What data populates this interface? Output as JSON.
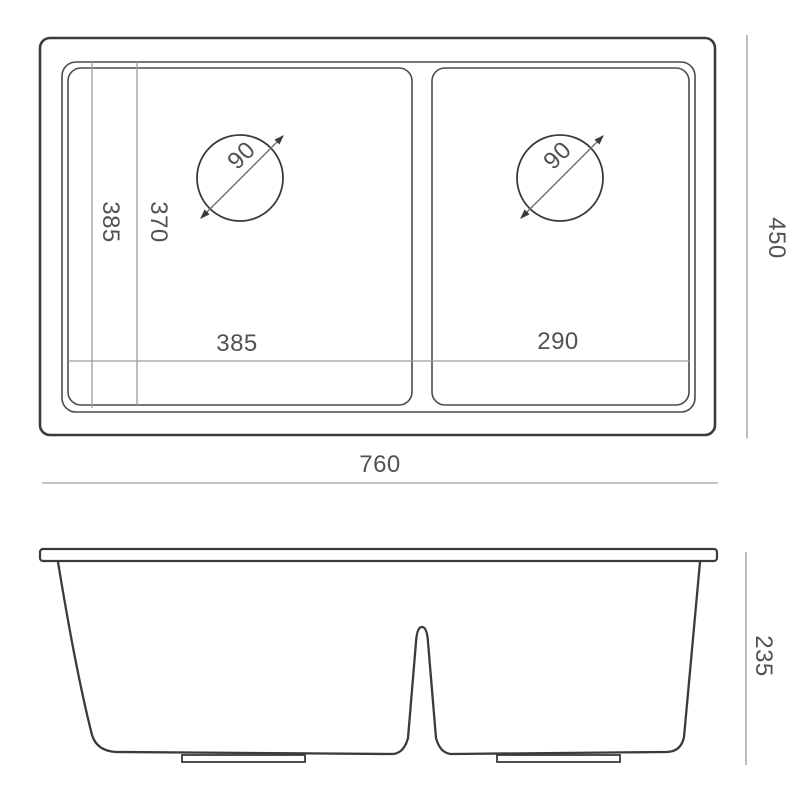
{
  "drawing": {
    "subject": "double-bowl-sink-dimension-drawing",
    "dimensions": {
      "top_view": {
        "overall_width": "760",
        "overall_depth": "450",
        "bowl_inner_length_a": "385",
        "bowl_inner_length_b": "370",
        "left_bowl_inner_width": "385",
        "right_bowl_inner_width": "290",
        "drain_diameter_left": "90",
        "drain_diameter_right": "90"
      },
      "side_view": {
        "bowl_depth": "235"
      }
    },
    "colors": {
      "background": "#ffffff",
      "outline": "#3a3b3d",
      "thin_outline": "#4a4b4d",
      "dimension_line": "#9b9c9e",
      "diagonal_line": "#6e6f71",
      "label_text": "#505255"
    }
  }
}
